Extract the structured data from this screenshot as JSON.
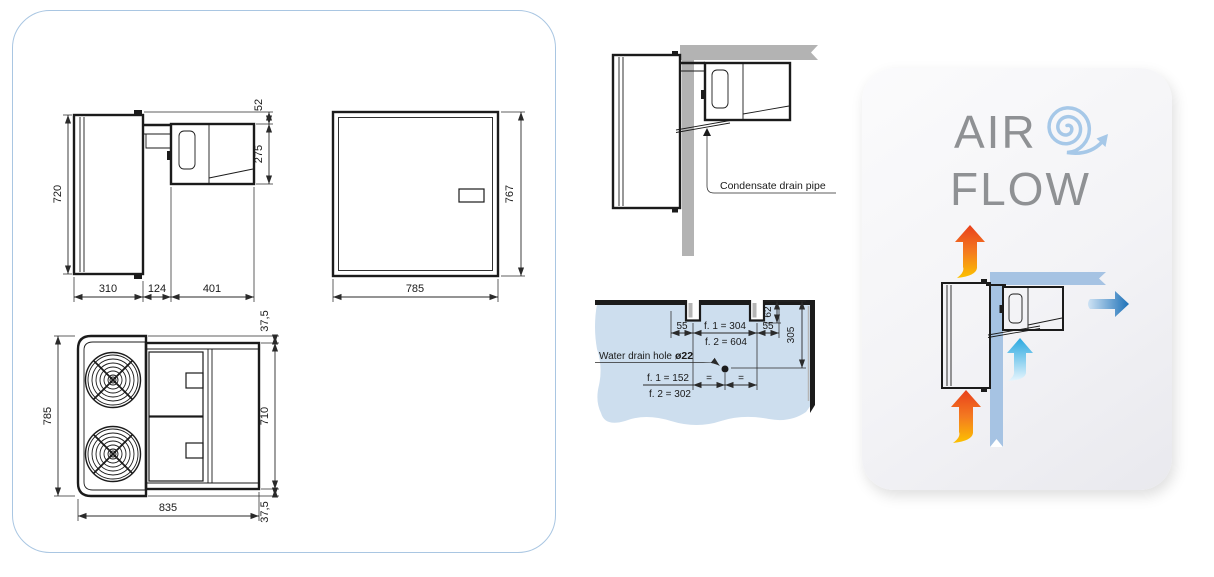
{
  "drawing_panel": {
    "side_view": {
      "dim_height": "720",
      "dim_top_offset": "52",
      "dim_unit_height": "275",
      "dim_depth_inside": "310",
      "dim_wall_thickness": "124",
      "dim_depth_outside": "401"
    },
    "front_view": {
      "dim_width": "785",
      "dim_height": "767"
    },
    "top_view": {
      "dim_body_height": "785",
      "dim_unit_depth": "710",
      "dim_total_width": "835",
      "dim_offset_top": "37,5",
      "dim_offset_bottom": "37,5"
    }
  },
  "installation_view": {
    "condensate_label": "Condensate drain pipe"
  },
  "template_view": {
    "drain_label": "Water drain hole",
    "drain_diameter": "ø22",
    "dim_left_offset": "55",
    "dim_span_f1": "f. 1 = 304",
    "dim_span_f2": "f. 2 = 604",
    "dim_right_offset": "55",
    "dim_notch_depth": "62",
    "dim_vertical": "305",
    "dim_hole_f1": "f. 1 = 152",
    "dim_hole_f2": "f. 2 = 302",
    "equal_left": "=",
    "equal_right": "="
  },
  "airflow_panel": {
    "title_line_1": "AIR",
    "title_line_2": "FLOW"
  },
  "colors": {
    "accent_border": "#a9c6e2",
    "wall_gray": "#b3b3b3",
    "template_blue": "#cddeee",
    "flow_wall_blue": "#a6c3e3",
    "line_black": "#1b1b1b",
    "title_gray": "#8f9194",
    "spiral_blue": "#a6c8e8",
    "arrow_red": "#e8401c",
    "arrow_yellow": "#fcc200",
    "arrow_blue": "#1d71b8",
    "arrow_cyan": "#29a8e0"
  }
}
